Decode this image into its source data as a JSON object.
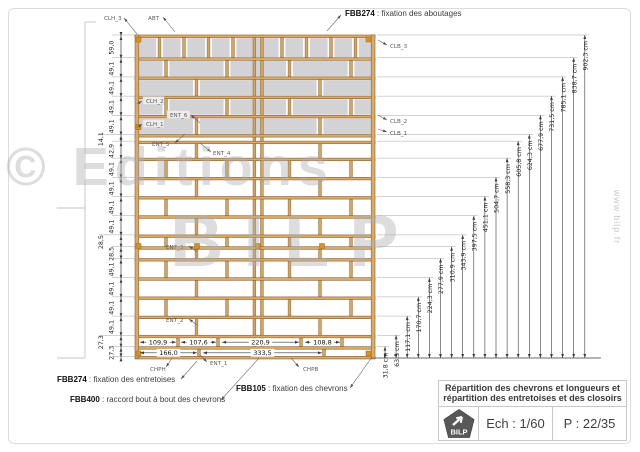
{
  "watermark": {
    "line1": "© Editions",
    "line2": "BILP",
    "site": "www.bilp.fr"
  },
  "notes": {
    "top": {
      "code": "FBB274",
      "desc": " : fixation des aboutages"
    },
    "bottom": [
      {
        "code": "FBB274",
        "desc": " : fixation des entretoises"
      },
      {
        "code": "FBB105",
        "desc": " : fixation des chevrons"
      },
      {
        "code": "FBB400",
        "desc": " : raccord bout à bout des chevrons"
      }
    ]
  },
  "part_labels": [
    {
      "id": "CLH_3",
      "text": "CLH_3"
    },
    {
      "id": "ABT",
      "text": "ABT"
    },
    {
      "id": "CLB_3",
      "text": "CLB_3"
    },
    {
      "id": "CLH_2",
      "text": "CLH_2"
    },
    {
      "id": "ENT_6",
      "text": "ENT_6"
    },
    {
      "id": "CLH_1",
      "text": "CLH_1"
    },
    {
      "id": "CLB_2",
      "text": "CLB_2"
    },
    {
      "id": "CLB_1",
      "text": "CLB_1"
    },
    {
      "id": "ENT_5",
      "text": "ENT_5"
    },
    {
      "id": "ENT_4",
      "text": "ENT_4"
    },
    {
      "id": "ENT_3",
      "text": "ENT_3"
    },
    {
      "id": "ENT_2",
      "text": "ENT_2"
    },
    {
      "id": "ENT_1",
      "text": "ENT_1"
    },
    {
      "id": "CHPH",
      "text": "CHPH"
    },
    {
      "id": "CHPB",
      "text": "CHPB"
    }
  ],
  "left_dims": [
    {
      "label": "59,0",
      "cm": 59.0
    },
    {
      "label": "49,1",
      "cm": 49.1
    },
    {
      "label": "49,1",
      "cm": 49.1
    },
    {
      "label": "49,1",
      "cm": 49.1
    },
    {
      "label": "49,1",
      "cm": 49.1
    },
    {
      "label": "14,1",
      "cm": 14.1,
      "offset": true
    },
    {
      "label": "42,9",
      "cm": 42.9
    },
    {
      "label": "49,1",
      "cm": 49.1
    },
    {
      "label": "49,1",
      "cm": 49.1
    },
    {
      "label": "49,1",
      "cm": 49.1
    },
    {
      "label": "49,1",
      "cm": 49.1
    },
    {
      "label": "28,5",
      "cm": 28.5,
      "offset": true
    },
    {
      "label": "28,5",
      "cm": 28.5
    },
    {
      "label": "49,1",
      "cm": 49.1
    },
    {
      "label": "49,1",
      "cm": 49.1
    },
    {
      "label": "49,1",
      "cm": 49.1
    },
    {
      "label": "49,1",
      "cm": 49.1
    },
    {
      "label": "27,3",
      "cm": 27.3,
      "offset": true
    },
    {
      "label": "27,3",
      "cm": 27.3
    }
  ],
  "right_dims": [
    {
      "label": "31,8 cm",
      "cm": 31.8
    },
    {
      "label": "63,5 cm",
      "cm": 63.5
    },
    {
      "label": "117,1 cm",
      "cm": 117.1
    },
    {
      "label": "170,7 cm",
      "cm": 170.7
    },
    {
      "label": "224,3 cm",
      "cm": 224.3
    },
    {
      "label": "277,9 cm",
      "cm": 277.9
    },
    {
      "label": "310,9 cm",
      "cm": 310.9
    },
    {
      "label": "343,9 cm",
      "cm": 343.9
    },
    {
      "label": "397,5 cm",
      "cm": 397.5
    },
    {
      "label": "451,1 cm",
      "cm": 451.1
    },
    {
      "label": "504,7 cm",
      "cm": 504.7
    },
    {
      "label": "558,3 cm",
      "cm": 558.3
    },
    {
      "label": "605,8 cm",
      "cm": 605.8
    },
    {
      "label": "624,3 cm",
      "cm": 624.3
    },
    {
      "label": "677,9 cm",
      "cm": 677.9
    },
    {
      "label": "731,5 cm",
      "cm": 731.5
    },
    {
      "label": "785,1 cm",
      "cm": 785.1
    },
    {
      "label": "838,7 cm",
      "cm": 838.7
    },
    {
      "label": "902,3 cm",
      "cm": 902.3
    }
  ],
  "bottom_dims": {
    "row1": [
      {
        "label": "109,9",
        "cm": 109.9
      },
      {
        "label": "107,6",
        "cm": 107.6
      },
      {
        "label": "220,9",
        "cm": 220.9
      },
      {
        "label": "108,8",
        "cm": 108.8
      }
    ],
    "row2": [
      {
        "label": "166,0",
        "cm": 166.0
      },
      {
        "label": "333,5",
        "cm": 333.5
      }
    ]
  },
  "title_block": {
    "line1": "Répartition des chevrons et longueurs et",
    "line2": "répartition des entretoises et des closoirs",
    "logo": "BILP",
    "scale": "Ech : 1/60",
    "page": "P : 22/35"
  },
  "structure": {
    "beam_thickness_cm": 4.5,
    "total_height_cm": 902.3
  }
}
